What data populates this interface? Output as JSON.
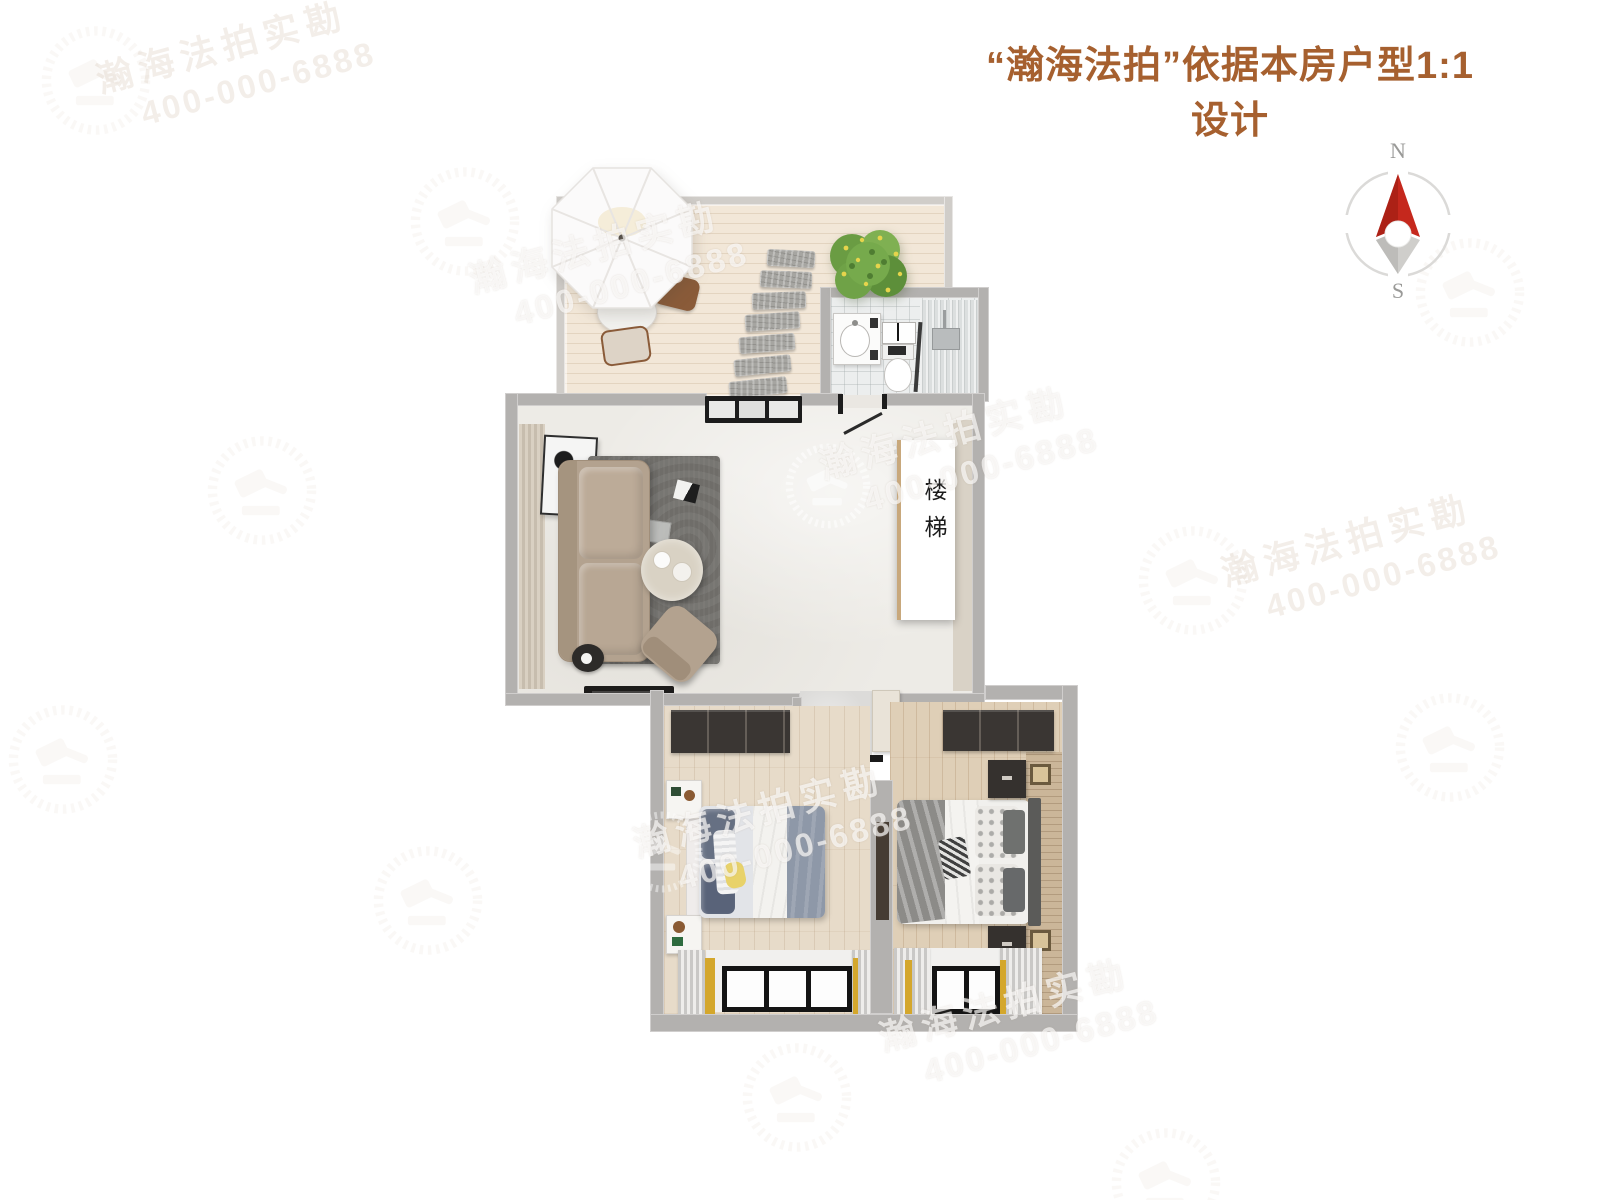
{
  "title": {
    "text": "“瀚海法拍”依据本房户型1:1设计",
    "color": "#a6602f"
  },
  "compass": {
    "north": "N",
    "south": "S",
    "needle_red": "#c5281d",
    "needle_gray": "#cfcecb",
    "ring_gray": "#dbdad8"
  },
  "plan": {
    "stair_label": "楼梯"
  },
  "watermark": {
    "line1": "瀚海法拍实勘",
    "line2": "400-000-6888"
  },
  "colors": {
    "wall_gray": "#b3b1af",
    "terrace_wall": "#d0cdc9",
    "deck_wood": "#eadbc7",
    "living_floor": "#edebe6",
    "bedroom_wood": "#e7dbc9",
    "rug_gray": "#6f6d69",
    "sofa_taupe": "#b3a28f",
    "curtain_yellow": "#d4a72c",
    "plant_green": "#6a9c43",
    "blanket_blue": "#8e98a8",
    "watermark_white": "#ffffff"
  }
}
